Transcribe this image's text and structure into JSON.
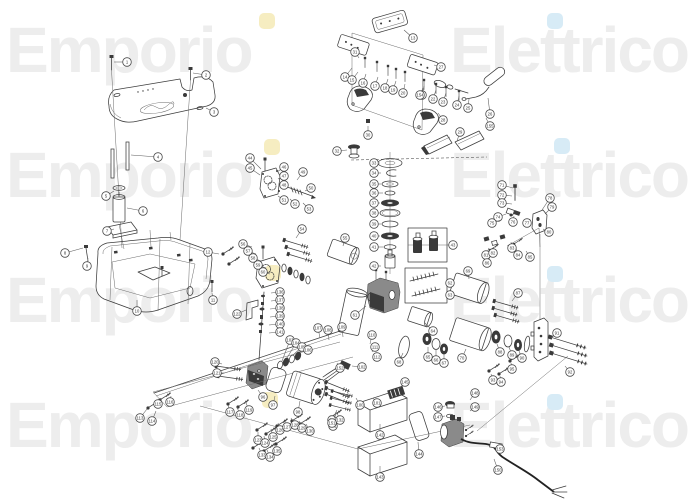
{
  "watermark": {
    "word1": "Emporio",
    "word2": "Elettrico",
    "color": "#ededed",
    "rows": [
      18,
      143,
      268,
      393
    ],
    "accent_dots": [
      {
        "color": "#f6edc1",
        "x": 259,
        "y": 13
      },
      {
        "color": "#d7ebf6",
        "x": 547,
        "y": 13
      },
      {
        "color": "#f6edc1",
        "x": 264,
        "y": 139
      },
      {
        "color": "#d7ebf6",
        "x": 554,
        "y": 138
      },
      {
        "color": "#f6edc1",
        "x": 265,
        "y": 265
      },
      {
        "color": "#d7ebf6",
        "x": 547,
        "y": 266
      },
      {
        "color": "#f6edc1",
        "x": 262,
        "y": 392
      },
      {
        "color": "#d7ebf6",
        "x": 547,
        "y": 394
      }
    ]
  },
  "diagram": {
    "kind": "exploded-parts-diagram",
    "line_color": "#3c3c3c",
    "parts": [
      "top-cover-plate",
      "cover-bolt",
      "standoff-rod",
      "filter-canister",
      "mounting-plate",
      "oil-tank",
      "pedal-plate",
      "pedal-ghost-frame",
      "rocker-pedal",
      "control-handle",
      "wedge-pad",
      "filler-cap",
      "seal-washer-stack",
      "piston-detail-box",
      "spring-detail-box",
      "upper-gear-pump",
      "lower-gear-pump",
      "center-pump-body",
      "hydraulic-cylinder",
      "end-flange",
      "fitting-cluster",
      "drive-shaft",
      "electric-motor",
      "motor-gasket",
      "valve-block",
      "wiring-harness",
      "mounting-panel",
      "cover-box",
      "cover-gasket",
      "vent-grille",
      "power-pump-unit",
      "power-cable",
      "fastener-screw"
    ],
    "callouts": [
      {
        "n": 1,
        "x": 127,
        "y": 62,
        "lx": 114,
        "ly": 62
      },
      {
        "n": 2,
        "x": 206,
        "y": 75,
        "lx": 193,
        "ly": 73
      },
      {
        "n": 3,
        "x": 214,
        "y": 112,
        "lx": 206,
        "ly": 108
      },
      {
        "n": 4,
        "x": 158,
        "y": 157,
        "lx": 131,
        "ly": 155
      },
      {
        "n": 5,
        "x": 106,
        "y": 196,
        "lx": 114,
        "ly": 191
      },
      {
        "n": 6,
        "x": 143,
        "y": 211,
        "lx": 127,
        "ly": 208
      },
      {
        "n": 7,
        "x": 107,
        "y": 231,
        "lx": 114,
        "ly": 229
      },
      {
        "n": 8,
        "x": 65,
        "y": 253,
        "lx": 83,
        "ly": 248
      },
      {
        "n": 9,
        "x": 87,
        "y": 266,
        "lx": 88,
        "ly": 258
      },
      {
        "n": 10,
        "x": 137,
        "y": 311,
        "lx": 137,
        "ly": 300
      },
      {
        "n": 11,
        "x": 213,
        "y": 300,
        "lx": 212,
        "ly": 293
      },
      {
        "n": 12,
        "x": 208,
        "y": 252,
        "lx": 219,
        "ly": 254
      },
      {
        "n": 13,
        "x": 413,
        "y": 38,
        "lx": 404,
        "ly": 30
      },
      {
        "n": 14,
        "x": 345,
        "y": 77,
        "lx": 352,
        "ly": 68
      },
      {
        "n": 15,
        "x": 352,
        "y": 80,
        "lx": 358,
        "ly": 72
      },
      {
        "n": 16,
        "x": 363,
        "y": 83,
        "lx": 366,
        "ly": 74
      },
      {
        "n": 17,
        "x": 375,
        "y": 86,
        "lx": 378,
        "ly": 77
      },
      {
        "n": 18,
        "x": 385,
        "y": 88,
        "lx": 388,
        "ly": 79
      },
      {
        "n": 19,
        "x": 393,
        "y": 90,
        "lx": 396,
        "ly": 81
      },
      {
        "n": 20,
        "x": 403,
        "y": 93,
        "lx": 405,
        "ly": 84
      },
      {
        "n": 21,
        "x": 422,
        "y": 95,
        "lx": 424,
        "ly": 86
      },
      {
        "n": 22,
        "x": 433,
        "y": 99,
        "lx": 436,
        "ly": 90
      },
      {
        "n": 23,
        "x": 443,
        "y": 102,
        "lx": 446,
        "ly": 93
      },
      {
        "n": 24,
        "x": 457,
        "y": 105,
        "lx": 459,
        "ly": 96
      },
      {
        "n": 25,
        "x": 468,
        "y": 108,
        "lx": 469,
        "ly": 99
      },
      {
        "n": 26,
        "x": 490,
        "y": 114,
        "lx": 488,
        "ly": 98
      },
      {
        "n": 27,
        "x": 441,
        "y": 67,
        "lx": 434,
        "ly": 65
      },
      {
        "n": 28,
        "x": 443,
        "y": 120,
        "lx": 438,
        "ly": 113
      },
      {
        "n": 29,
        "x": 460,
        "y": 132,
        "lx": 457,
        "ly": 141
      },
      {
        "n": 30,
        "x": 368,
        "y": 135,
        "lx": 368,
        "ly": 126
      },
      {
        "n": 31,
        "x": 355,
        "y": 52,
        "lx": 359,
        "ly": 58
      },
      {
        "n": 32,
        "x": 337,
        "y": 151,
        "lx": 347,
        "ly": 150
      },
      {
        "n": 33,
        "x": 374,
        "y": 163,
        "lx": 380,
        "ly": 163
      },
      {
        "n": 34,
        "x": 374,
        "y": 173,
        "lx": 381,
        "ly": 173
      },
      {
        "n": 35,
        "x": 374,
        "y": 184,
        "lx": 381,
        "ly": 184
      },
      {
        "n": 36,
        "x": 374,
        "y": 193,
        "lx": 383,
        "ly": 193
      },
      {
        "n": 37,
        "x": 374,
        "y": 203,
        "lx": 380,
        "ly": 203
      },
      {
        "n": 38,
        "x": 374,
        "y": 213,
        "lx": 379,
        "ly": 213
      },
      {
        "n": 39,
        "x": 374,
        "y": 224,
        "lx": 381,
        "ly": 224
      },
      {
        "n": 40,
        "x": 374,
        "y": 236,
        "lx": 380,
        "ly": 236
      },
      {
        "n": 41,
        "x": 374,
        "y": 247,
        "lx": 383,
        "ly": 247
      },
      {
        "n": 42,
        "x": 374,
        "y": 266,
        "lx": 381,
        "ly": 266
      },
      {
        "n": 43,
        "x": 453,
        "y": 245,
        "lx": 447,
        "ly": 245
      },
      {
        "n": 44,
        "x": 250,
        "y": 158,
        "lx": 261,
        "ly": 169
      },
      {
        "n": 45,
        "x": 250,
        "y": 168,
        "lx": 260,
        "ly": 175
      },
      {
        "n": 46,
        "x": 284,
        "y": 167,
        "lx": 277,
        "ly": 172
      },
      {
        "n": 47,
        "x": 284,
        "y": 176,
        "lx": 278,
        "ly": 179
      },
      {
        "n": 48,
        "x": 284,
        "y": 185,
        "lx": 279,
        "ly": 185
      },
      {
        "n": 49,
        "x": 303,
        "y": 172,
        "lx": 297,
        "ly": 180
      },
      {
        "n": 50,
        "x": 311,
        "y": 188,
        "lx": 305,
        "ly": 191
      },
      {
        "n": 51,
        "x": 284,
        "y": 200,
        "lx": 278,
        "ly": 196
      },
      {
        "n": 52,
        "x": 295,
        "y": 204,
        "lx": 290,
        "ly": 199
      },
      {
        "n": 53,
        "x": 309,
        "y": 209,
        "lx": 303,
        "ly": 203
      },
      {
        "n": 54,
        "x": 302,
        "y": 229,
        "lx": 296,
        "ly": 238
      },
      {
        "n": 55,
        "x": 345,
        "y": 238,
        "lx": 343,
        "ly": 246
      },
      {
        "n": 56,
        "x": 243,
        "y": 244,
        "lx": 252,
        "ly": 247
      },
      {
        "n": 57,
        "x": 248,
        "y": 251,
        "lx": 256,
        "ly": 254
      },
      {
        "n": 58,
        "x": 253,
        "y": 258,
        "lx": 261,
        "ly": 261
      },
      {
        "n": 59,
        "x": 258,
        "y": 265,
        "lx": 266,
        "ly": 268
      },
      {
        "n": 60,
        "x": 263,
        "y": 272,
        "lx": 270,
        "ly": 274
      },
      {
        "n": 61,
        "x": 355,
        "y": 315,
        "lx": 366,
        "ly": 306
      },
      {
        "n": 62,
        "x": 450,
        "y": 283,
        "lx": 447,
        "ly": 283
      },
      {
        "n": 63,
        "x": 450,
        "y": 295,
        "lx": 447,
        "ly": 295
      },
      {
        "n": 64,
        "x": 433,
        "y": 331,
        "lx": 425,
        "ly": 323
      },
      {
        "n": 65,
        "x": 428,
        "y": 357,
        "lx": 428,
        "ly": 347
      },
      {
        "n": 66,
        "x": 436,
        "y": 360,
        "lx": 436,
        "ly": 350
      },
      {
        "n": 67,
        "x": 444,
        "y": 363,
        "lx": 444,
        "ly": 354
      },
      {
        "n": 68,
        "x": 399,
        "y": 362,
        "lx": 403,
        "ly": 353
      },
      {
        "n": 69,
        "x": 468,
        "y": 271,
        "lx": 469,
        "ly": 279
      },
      {
        "n": 70,
        "x": 462,
        "y": 358,
        "lx": 466,
        "ly": 349
      },
      {
        "n": 71,
        "x": 502,
        "y": 185,
        "lx": 513,
        "ly": 188
      },
      {
        "n": 72,
        "x": 502,
        "y": 195,
        "lx": 512,
        "ly": 196
      },
      {
        "n": 73,
        "x": 502,
        "y": 203,
        "lx": 512,
        "ly": 204
      },
      {
        "n": 74,
        "x": 498,
        "y": 217,
        "lx": 506,
        "ly": 214
      },
      {
        "n": 75,
        "x": 492,
        "y": 223,
        "lx": 501,
        "ly": 220
      },
      {
        "n": 76,
        "x": 513,
        "y": 222,
        "lx": 514,
        "ly": 216
      },
      {
        "n": 77,
        "x": 527,
        "y": 223,
        "lx": 530,
        "ly": 219
      },
      {
        "n": 78,
        "x": 550,
        "y": 198,
        "lx": 542,
        "ly": 210
      },
      {
        "n": 79,
        "x": 552,
        "y": 207,
        "lx": 545,
        "ly": 214
      },
      {
        "n": 80,
        "x": 549,
        "y": 232,
        "lx": 543,
        "ly": 229
      },
      {
        "n": 81,
        "x": 486,
        "y": 255,
        "lx": 489,
        "ly": 248
      },
      {
        "n": 82,
        "x": 493,
        "y": 253,
        "lx": 494,
        "ly": 247
      },
      {
        "n": 83,
        "x": 512,
        "y": 248,
        "lx": 511,
        "ly": 242
      },
      {
        "n": 84,
        "x": 518,
        "y": 255,
        "lx": 516,
        "ly": 248
      },
      {
        "n": 85,
        "x": 530,
        "y": 257,
        "lx": 526,
        "ly": 251
      },
      {
        "n": 86,
        "x": 487,
        "y": 263,
        "lx": 490,
        "ly": 257
      },
      {
        "n": 87,
        "x": 518,
        "y": 293,
        "lx": 512,
        "ly": 301
      },
      {
        "n": 88,
        "x": 500,
        "y": 352,
        "lx": 497,
        "ly": 344
      },
      {
        "n": 89,
        "x": 512,
        "y": 355,
        "lx": 509,
        "ly": 347
      },
      {
        "n": 90,
        "x": 522,
        "y": 358,
        "lx": 519,
        "ly": 351
      },
      {
        "n": 91,
        "x": 557,
        "y": 333,
        "lx": 551,
        "ly": 338
      },
      {
        "n": 92,
        "x": 570,
        "y": 372,
        "lx": 565,
        "ly": 366
      },
      {
        "n": 93,
        "x": 493,
        "y": 380,
        "lx": 491,
        "ly": 374
      },
      {
        "n": 94,
        "x": 501,
        "y": 382,
        "lx": 500,
        "ly": 376
      },
      {
        "n": 95,
        "x": 512,
        "y": 369,
        "lx": 511,
        "ly": 363
      },
      {
        "n": 96,
        "x": 263,
        "y": 397,
        "lx": 258,
        "ly": 390
      },
      {
        "n": 97,
        "x": 273,
        "y": 405,
        "lx": 275,
        "ly": 396
      },
      {
        "n": 98,
        "x": 298,
        "y": 412,
        "lx": 300,
        "ly": 401
      },
      {
        "n": 99,
        "x": 332,
        "y": 420,
        "lx": 337,
        "ly": 410
      },
      {
        "n": 100,
        "x": 360,
        "y": 405,
        "lx": 356,
        "ly": 398
      },
      {
        "n": 101,
        "x": 377,
        "y": 403,
        "lx": 373,
        "ly": 398
      },
      {
        "n": 102,
        "x": 362,
        "y": 367,
        "lx": 352,
        "ly": 366
      },
      {
        "n": 103,
        "x": 290,
        "y": 340,
        "lx": 282,
        "ly": 361
      },
      {
        "n": 104,
        "x": 296,
        "y": 343,
        "lx": 287,
        "ly": 358
      },
      {
        "n": 105,
        "x": 302,
        "y": 347,
        "lx": 293,
        "ly": 355
      },
      {
        "n": 106,
        "x": 308,
        "y": 350,
        "lx": 299,
        "ly": 352
      },
      {
        "n": 107,
        "x": 318,
        "y": 328,
        "lx": 320,
        "ly": 338
      },
      {
        "n": 108,
        "x": 328,
        "y": 330,
        "lx": 329,
        "ly": 340
      },
      {
        "n": 109,
        "x": 342,
        "y": 327,
        "lx": 343,
        "ly": 337
      },
      {
        "n": 110,
        "x": 372,
        "y": 335,
        "lx": 370,
        "ly": 344
      },
      {
        "n": 111,
        "x": 375,
        "y": 347,
        "lx": 372,
        "ly": 352
      },
      {
        "n": 112,
        "x": 377,
        "y": 357,
        "lx": 374,
        "ly": 361
      },
      {
        "n": 113,
        "x": 140,
        "y": 418,
        "lx": 147,
        "ly": 409
      },
      {
        "n": 114,
        "x": 152,
        "y": 421,
        "lx": 156,
        "ly": 411
      },
      {
        "n": 115,
        "x": 158,
        "y": 404,
        "lx": 161,
        "ly": 398
      },
      {
        "n": 116,
        "x": 170,
        "y": 402,
        "lx": 171,
        "ly": 396
      },
      {
        "n": 117,
        "x": 230,
        "y": 412,
        "lx": 228,
        "ly": 405
      },
      {
        "n": 118,
        "x": 240,
        "y": 415,
        "lx": 237,
        "ly": 407
      },
      {
        "n": 119,
        "x": 249,
        "y": 410,
        "lx": 246,
        "ly": 403
      },
      {
        "n": 120,
        "x": 215,
        "y": 362,
        "lx": 222,
        "ly": 364
      },
      {
        "n": 121,
        "x": 217,
        "y": 373,
        "lx": 224,
        "ly": 373
      },
      {
        "n": 122,
        "x": 237,
        "y": 314,
        "lx": 246,
        "ly": 310
      },
      {
        "n": 123,
        "x": 258,
        "y": 440,
        "lx": 258,
        "ly": 432
      },
      {
        "n": 124,
        "x": 265,
        "y": 443,
        "lx": 264,
        "ly": 436
      },
      {
        "n": 125,
        "x": 273,
        "y": 437,
        "lx": 271,
        "ly": 429
      },
      {
        "n": 126,
        "x": 280,
        "y": 430,
        "lx": 278,
        "ly": 423
      },
      {
        "n": 127,
        "x": 287,
        "y": 427,
        "lx": 284,
        "ly": 420
      },
      {
        "n": 128,
        "x": 295,
        "y": 425,
        "lx": 291,
        "ly": 418
      },
      {
        "n": 129,
        "x": 302,
        "y": 428,
        "lx": 299,
        "ly": 421
      },
      {
        "n": 130,
        "x": 310,
        "y": 431,
        "lx": 306,
        "ly": 424
      },
      {
        "n": 131,
        "x": 333,
        "y": 426,
        "lx": 330,
        "ly": 418
      },
      {
        "n": 132,
        "x": 340,
        "y": 420,
        "lx": 337,
        "ly": 413
      },
      {
        "n": 133,
        "x": 262,
        "y": 455,
        "lx": 259,
        "ly": 448
      },
      {
        "n": 134,
        "x": 270,
        "y": 457,
        "lx": 267,
        "ly": 450
      },
      {
        "n": 135,
        "x": 277,
        "y": 451,
        "lx": 274,
        "ly": 444
      },
      {
        "n": 136,
        "x": 280,
        "y": 292,
        "lx": 271,
        "ly": 293
      },
      {
        "n": 137,
        "x": 280,
        "y": 300,
        "lx": 271,
        "ly": 301
      },
      {
        "n": 138,
        "x": 280,
        "y": 308,
        "lx": 270,
        "ly": 309
      },
      {
        "n": 139,
        "x": 280,
        "y": 316,
        "lx": 270,
        "ly": 317
      },
      {
        "n": 140,
        "x": 280,
        "y": 324,
        "lx": 269,
        "ly": 325
      },
      {
        "n": 141,
        "x": 280,
        "y": 332,
        "lx": 269,
        "ly": 333
      },
      {
        "n": 142,
        "x": 380,
        "y": 435,
        "lx": 380,
        "ly": 424
      },
      {
        "n": 143,
        "x": 380,
        "y": 477,
        "lx": 380,
        "ly": 466
      },
      {
        "n": 144,
        "x": 419,
        "y": 454,
        "lx": 418,
        "ly": 442
      },
      {
        "n": 145,
        "x": 405,
        "y": 382,
        "lx": 399,
        "ly": 389
      },
      {
        "n": 146,
        "x": 438,
        "y": 407,
        "lx": 445,
        "ly": 406
      },
      {
        "n": 147,
        "x": 438,
        "y": 417,
        "lx": 445,
        "ly": 416
      },
      {
        "n": 148,
        "x": 475,
        "y": 393,
        "lx": 470,
        "ly": 400
      },
      {
        "n": 149,
        "x": 475,
        "y": 407,
        "lx": 470,
        "ly": 411
      },
      {
        "n": 150,
        "x": 498,
        "y": 470,
        "lx": 494,
        "ly": 459
      },
      {
        "n": 151,
        "x": 332,
        "y": 423,
        "lx": 337,
        "ly": 412
      },
      {
        "n": 152,
        "x": 340,
        "y": 368,
        "lx": 337,
        "ly": 363
      },
      {
        "n": 153,
        "x": 500,
        "y": 449,
        "lx": 497,
        "ly": 446
      },
      {
        "n": 154,
        "x": 420,
        "y": 95,
        "lx": 423,
        "ly": 88
      },
      {
        "n": 155,
        "x": 490,
        "y": 126,
        "lx": 486,
        "ly": 118
      }
    ]
  }
}
